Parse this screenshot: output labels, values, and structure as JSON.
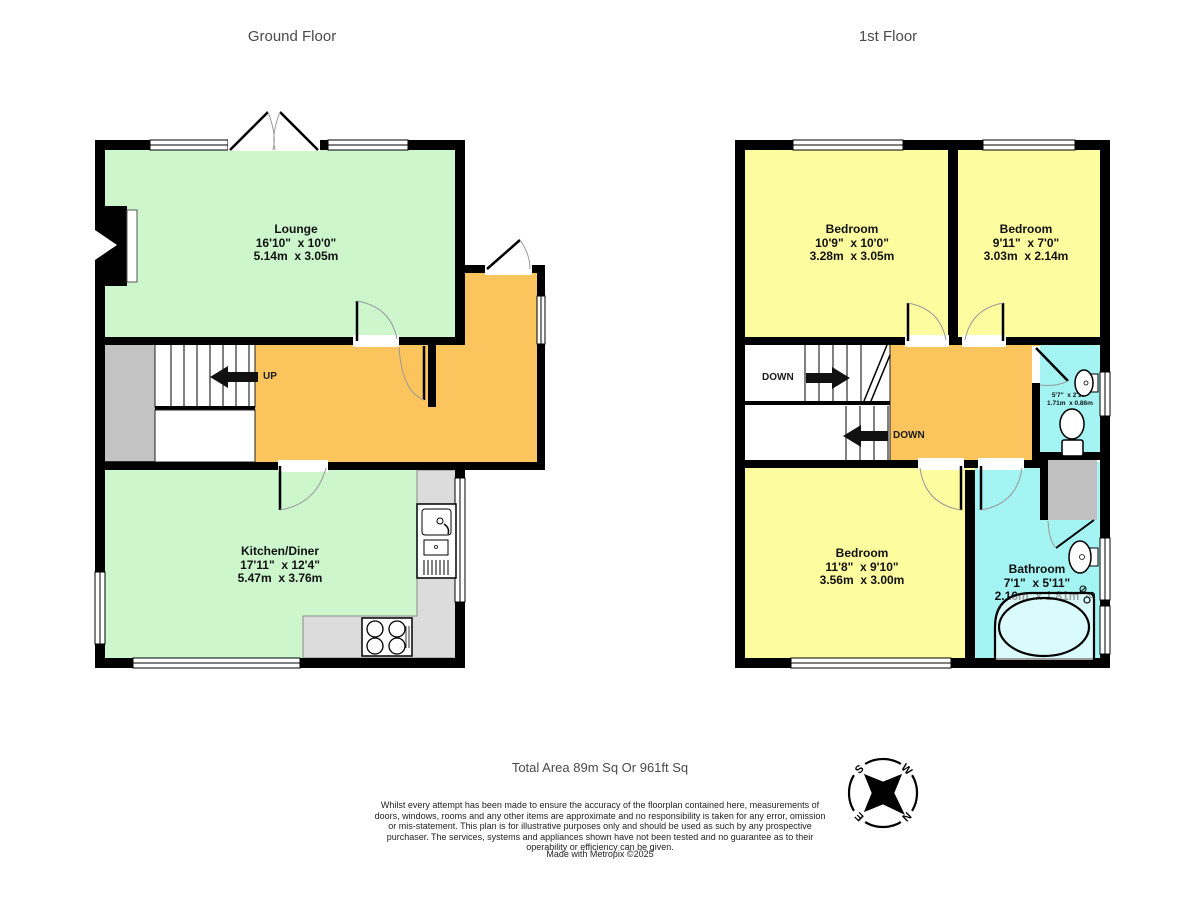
{
  "titles": {
    "ground": "Ground Floor",
    "first": "1st Floor"
  },
  "rooms": {
    "lounge": {
      "name": "Lounge",
      "imperial": "16'10\"  x 10'0\"",
      "metric": "5.14m  x 3.05m"
    },
    "kitchen": {
      "name": "Kitchen/Diner",
      "imperial": "17'11\"  x 12'4\"",
      "metric": "5.47m  x 3.76m"
    },
    "bedroom1": {
      "name": "Bedroom",
      "imperial": "10'9\"  x 10'0\"",
      "metric": "3.28m  x 3.05m"
    },
    "bedroom2": {
      "name": "Bedroom",
      "imperial": "9'11\"  x 7'0\"",
      "metric": "3.03m  x 2.14m"
    },
    "bedroom3": {
      "name": "Bedroom",
      "imperial": "11'8\"  x 9'10\"",
      "metric": "3.56m  x 3.00m"
    },
    "bathroom": {
      "name": "Bathroom",
      "imperial": "7'1\"  x 5'11\"",
      "metric": "2.16m  x 1.81m"
    },
    "wc": {
      "imperial": "5'7\"  x 2'10\"",
      "metric": "1.71m  x 0.86m"
    }
  },
  "stairs": {
    "up": "UP",
    "down1": "DOWN",
    "down2": "DOWN"
  },
  "compass": {
    "n": "N",
    "e": "E",
    "s": "S",
    "w": "W"
  },
  "footer": {
    "total_area": "Total Area 89m Sq Or 961ft Sq",
    "disclaimer": "Whilst every attempt has been made to ensure the accuracy of the floorplan contained here, measurements of doors, windows, rooms and any other items are approximate and no responsibility is taken for any error, omission or mis-statement. This plan is for illustrative purposes only and should be used as such by any prospective purchaser. The services, systems and appliances shown have not been tested and no guarantee as to their operability or efficiency can be given.",
    "credit": "Made with Metropix ©2025"
  },
  "colors": {
    "room_green": "#cdf6cd",
    "room_yellow": "#fdfc9e",
    "hall_orange": "#fcc45c",
    "wet_cyan": "#a4f4f4",
    "counter_gray": "#dcdcdc",
    "block_gray": "#c3c3c3",
    "wall_black": "#000000"
  }
}
